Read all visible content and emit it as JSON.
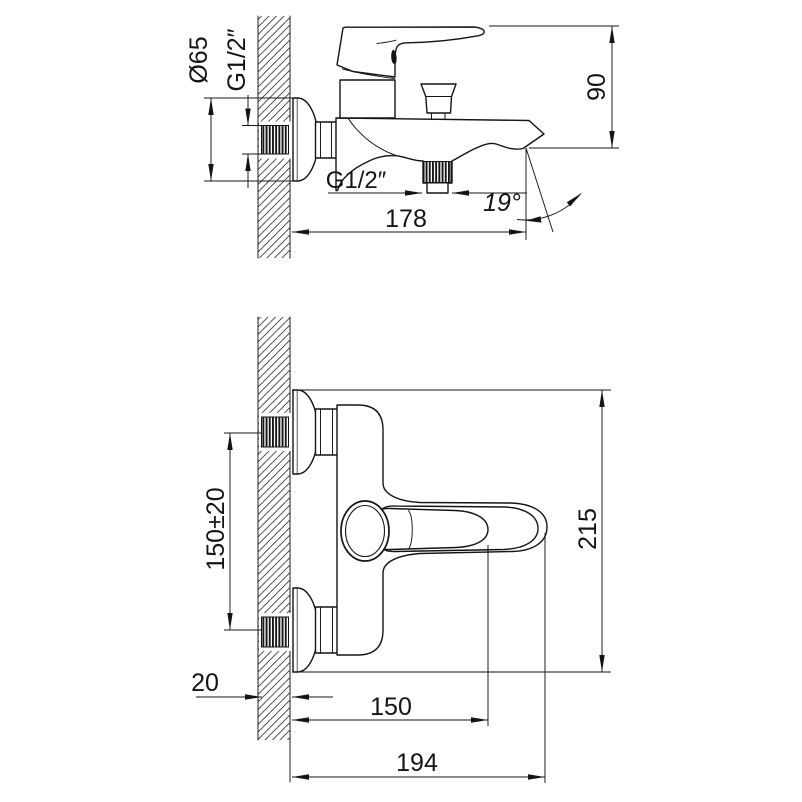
{
  "drawing": {
    "title": "wall-mounted bath mixer installation drawing",
    "background": "#ffffff",
    "line_color": "#141414",
    "views": {
      "side": {
        "labels": {
          "escutcheon_diameter": "Ø65",
          "inlet_thread": "G1/2″",
          "spout_to_top_height": "90",
          "shower_outlet_thread": "G1/2″",
          "wall_projection": "178",
          "spout_angle": "19°"
        }
      },
      "front": {
        "labels": {
          "inlet_spacing": "150±20",
          "overall_height": "215",
          "wall_thickness": "20",
          "handle_projection": "150",
          "overall_projection": "194"
        }
      }
    }
  }
}
